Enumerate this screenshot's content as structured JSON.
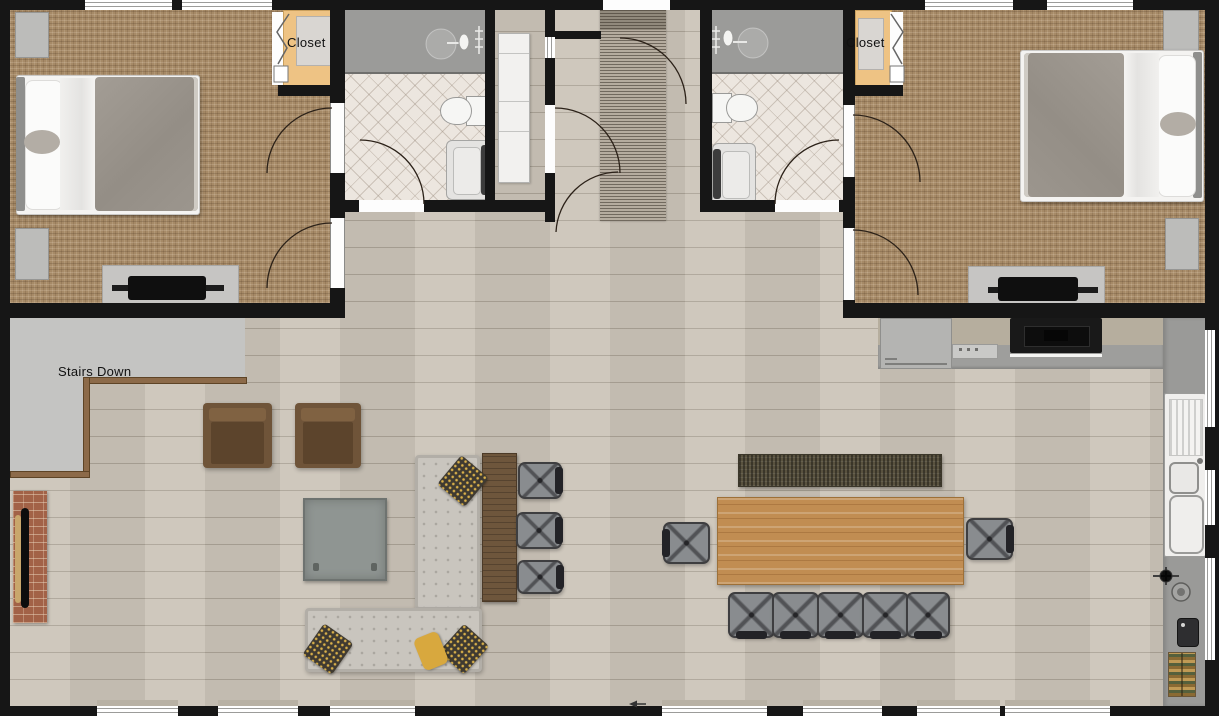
{
  "plan": {
    "labels": {
      "closet_left": "Closet",
      "closet_right": "Closet",
      "stairs_down": "Stairs Down"
    },
    "colors": {
      "wall": "#161616",
      "bedroom_carpet": "#a68a67",
      "wood_floor": "#ccc5b9",
      "bathroom_tile": "#ece6df",
      "shower": "#9b9b99",
      "closet_interior": "#eec384",
      "stairs_area": "#c4c4c2",
      "railing": "#8c6a49",
      "brick_fireplace": "#a26247",
      "sofa": "#c9c5be",
      "armchair": "#6f5439",
      "dining_table": "#c18d52",
      "accent_pillow_yellow": "#d8a83e",
      "kitchen_counter": "#9b9b99",
      "kitchen_backsplash": "#b6ae9e"
    }
  }
}
